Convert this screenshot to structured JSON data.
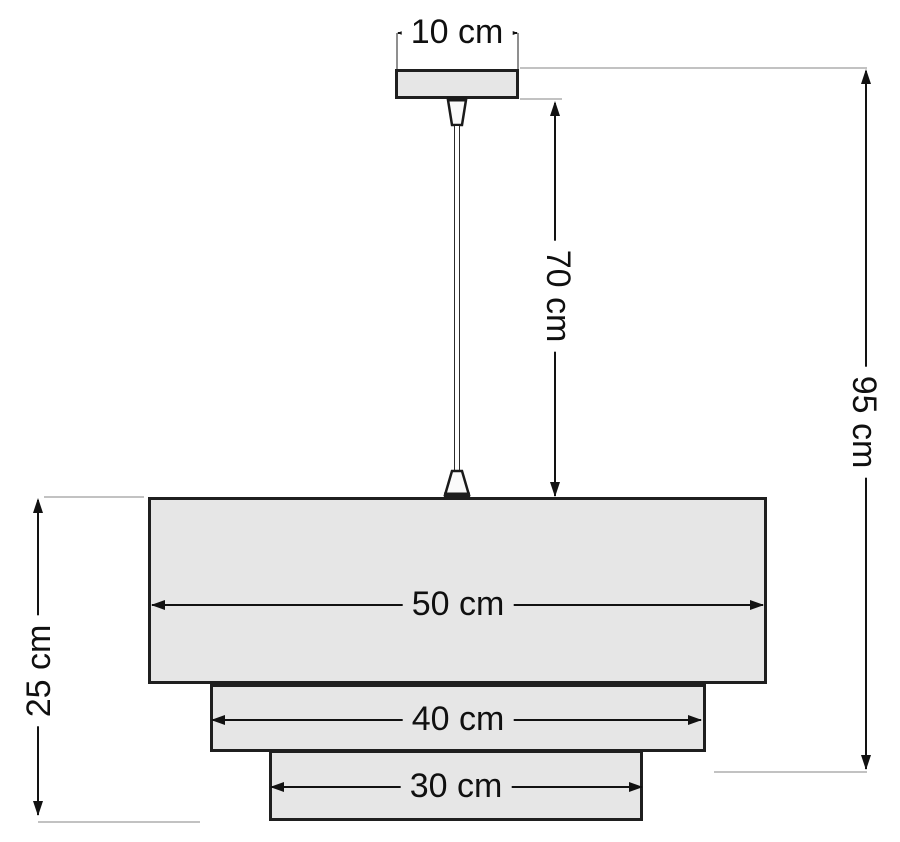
{
  "figure": {
    "type": "dimension-diagram",
    "unit": "cm",
    "colors": {
      "shape_fill": "#e6e6e6",
      "outline": "#1f1f1f",
      "dimension_line": "#121212",
      "extension_line": "#c2c2c2"
    },
    "dimensions": {
      "canopy_width": "10 cm",
      "cord_length": "70 cm",
      "total_height": "95 cm",
      "shade_height": "25 cm",
      "top_tier_width": "50 cm",
      "middle_tier_width": "40 cm",
      "bottom_tier_width": "30 cm"
    }
  }
}
